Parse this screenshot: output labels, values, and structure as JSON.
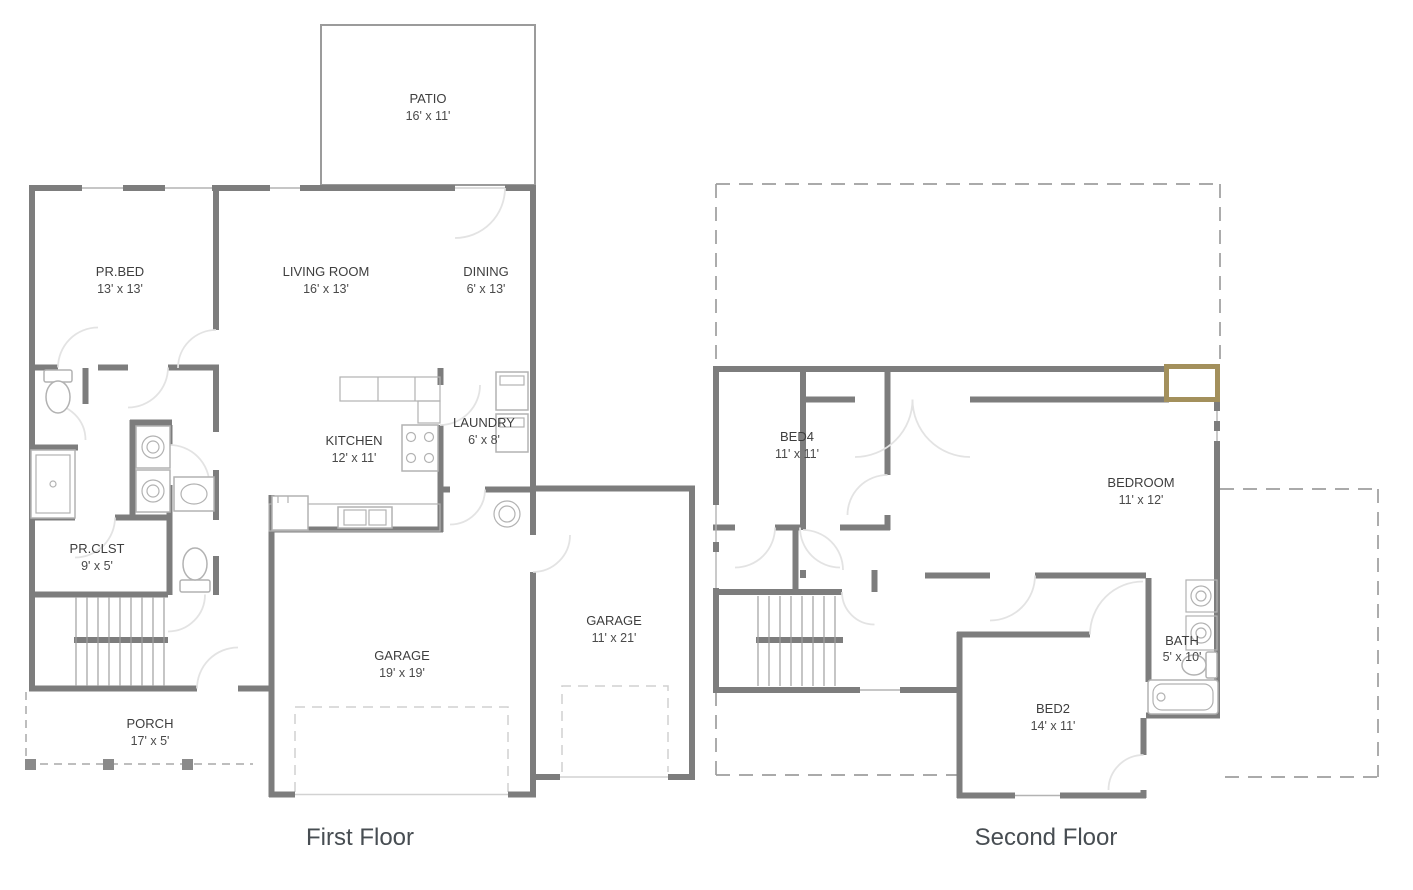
{
  "document": {
    "type": "house-floor-plan"
  },
  "floors": {
    "first": {
      "title": "First Floor",
      "rooms": [
        {
          "name": "PATIO",
          "dims": "16' x 11'"
        },
        {
          "name": "PR.BED",
          "dims": "13' x 13'"
        },
        {
          "name": "LIVING ROOM",
          "dims": "16' x 13'"
        },
        {
          "name": "DINING",
          "dims": "6' x 13'"
        },
        {
          "name": "KITCHEN",
          "dims": "12' x 11'"
        },
        {
          "name": "LAUNDRY",
          "dims": "6' x 8'"
        },
        {
          "name": "PR.CLST",
          "dims": "9' x 5'"
        },
        {
          "name": "GARAGE",
          "dims": "19' x 19'"
        },
        {
          "name": "GARAGE",
          "dims": "11' x 21'"
        },
        {
          "name": "PORCH",
          "dims": "17' x 5'"
        }
      ]
    },
    "second": {
      "title": "Second Floor",
      "rooms": [
        {
          "name": "BED4",
          "dims": "11' x 11'"
        },
        {
          "name": "BEDROOM",
          "dims": "11' x 12'"
        },
        {
          "name": "BATH",
          "dims": "5' x 10'"
        },
        {
          "name": "BED2",
          "dims": "14' x 11'"
        }
      ]
    }
  },
  "colors": {
    "wall": "#7d7d7d",
    "fixture": "#b2b2b2",
    "door_arc": "#e3e3e3",
    "dashed_outline": "#9e9e9e",
    "accent_tan": "#a3905c",
    "label_text": "#3e3e3e",
    "title_text": "#474d52",
    "background": "#ffffff"
  }
}
